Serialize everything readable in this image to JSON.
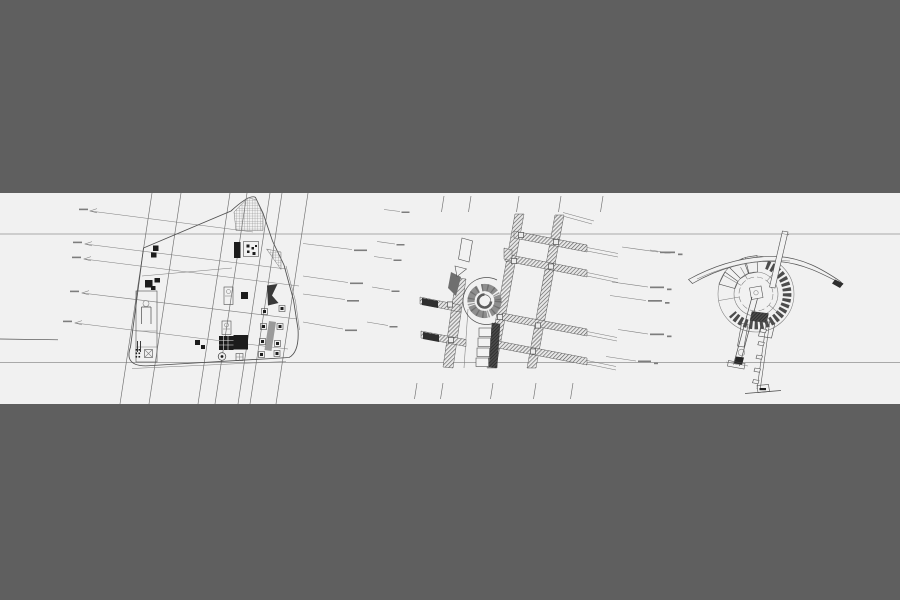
{
  "viewport": {
    "kind": "cad-sheet-viewer",
    "sheet_band": "horizontal white sheet strip across dark canvas",
    "datum_lines": 2
  },
  "colors": {
    "bg": "#5f5f5f",
    "sheet": "#f1f1f1",
    "ink": "#4f4f4f",
    "inklight": "#7d7d7d",
    "grid": "#6e6e6e",
    "datum": "#a9a9a9",
    "darkfill": "#1c1c1c"
  },
  "drawings": [
    {
      "id": "site-plan",
      "label": "Triangular site plan with crosshatched corner, building blocks and slanted construction lines"
    },
    {
      "id": "street-grid",
      "label": "Street grid plan with roundabout and diagonally hatched road bands"
    },
    {
      "id": "circular-structure",
      "label": "Circular structure plan with curved canopy, mast and stair strut"
    }
  ],
  "annotations": {
    "left_leader_count": 5,
    "middle_left_leader_count": 4,
    "middle_right_leader_count": 5,
    "standalone_note_count": 5,
    "text_legibility": "dimension/leader micro-text illegible at source resolution",
    "visible_text": []
  }
}
